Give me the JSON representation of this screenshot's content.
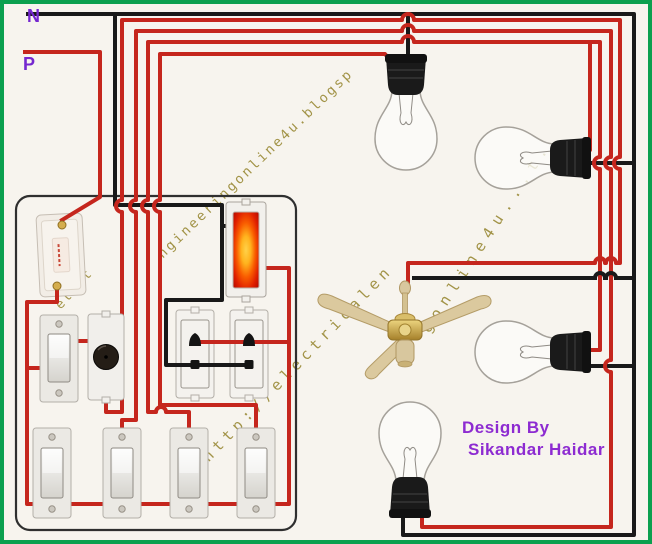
{
  "diagram": {
    "title_labels": {
      "neutral": "N",
      "phase": "P"
    },
    "credit": {
      "line1": "Design By",
      "line2": "Sikandar Haidar"
    },
    "watermarks": {
      "left": "elect",
      "top": "ngineeringonline4u.blogsp",
      "right": "gonline4u...t.",
      "bottom": "http://electricalen"
    },
    "colors": {
      "phase_wire": "#c5261d",
      "neutral_wire": "#191919",
      "frame_green": "#0ba04f",
      "label_purple": "#7527cf",
      "credit_purple": "#8d2bd1",
      "watermark_olive": "#8d7c1e",
      "indicator_glow_center": "#ffd24a",
      "indicator_glow_edge": "#c01000"
    },
    "components": [
      "cutout-fuse",
      "fan-switch",
      "fan-regulator",
      "indicator-lamp",
      "two-pin-socket",
      "two-pin-socket",
      "rocker-switch",
      "rocker-switch",
      "rocker-switch",
      "rocker-switch",
      "bulb",
      "bulb",
      "bulb",
      "bulb",
      "ceiling-fan"
    ]
  }
}
